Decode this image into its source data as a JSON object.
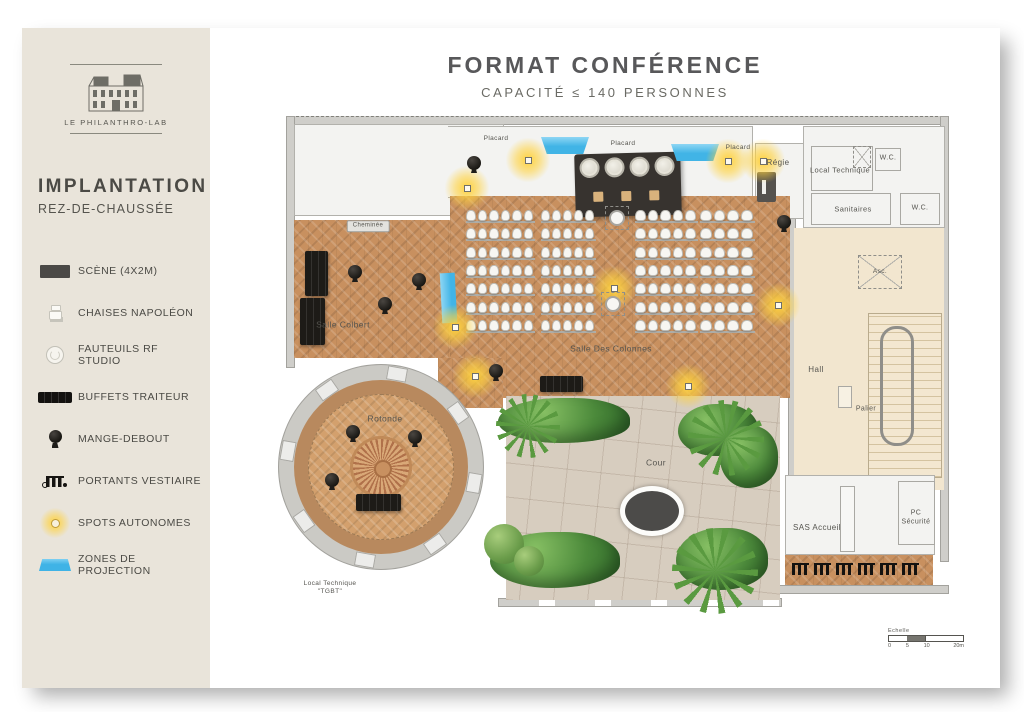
{
  "header": {
    "title": "FORMAT CONFÉRENCE",
    "subtitle": "CAPACITÉ ≤ 140 PERSONNES"
  },
  "sidebar": {
    "logo_caption": "LE PHILANTHRO-LAB",
    "heading": "IMPLANTATION",
    "subheading": "REZ-DE-CHAUSSÉE",
    "legend": [
      {
        "icon": "stage-icon",
        "label": "SCÈNE (4X2M)"
      },
      {
        "icon": "napoleon-chair-icon",
        "label": "CHAISES NAPOLÉON"
      },
      {
        "icon": "rf-armchair-icon",
        "label": "FAUTEUILS RF STUDIO"
      },
      {
        "icon": "buffet-icon",
        "label": "BUFFETS TRAITEUR"
      },
      {
        "icon": "standing-table-icon",
        "label": "MANGE-DEBOUT"
      },
      {
        "icon": "coat-rack-icon",
        "label": "PORTANTS VESTIAIRE"
      },
      {
        "icon": "spot-icon",
        "label": "SPOTS AUTONOMES"
      },
      {
        "icon": "projection-zone-icon",
        "label": "ZONES DE PROJECTION"
      }
    ]
  },
  "plan": {
    "labels": [
      {
        "t": "Placard",
        "x": 228,
        "y": 31,
        "s": 6.5
      },
      {
        "t": "Placard",
        "x": 355,
        "y": 36,
        "s": 6.5
      },
      {
        "t": "Placard",
        "x": 470,
        "y": 40,
        "s": 6.5
      },
      {
        "t": "Régie",
        "x": 510,
        "y": 55,
        "s": 8
      },
      {
        "t": "Local Technique",
        "x": 572,
        "y": 62,
        "s": 7.5
      },
      {
        "t": "W.C.",
        "x": 620,
        "y": 51,
        "s": 7
      },
      {
        "t": "Sanitaires",
        "x": 585,
        "y": 101,
        "s": 7.5
      },
      {
        "t": "W.C.",
        "x": 652,
        "y": 101,
        "s": 7
      },
      {
        "t": "Asc.",
        "x": 612,
        "y": 164,
        "s": 6.5
      },
      {
        "t": "Cheminée",
        "x": 100,
        "y": 118,
        "s": 6,
        "chip": true
      },
      {
        "t": "Salle Colbert",
        "x": 75,
        "y": 217,
        "s": 8.5
      },
      {
        "t": "Salle Des Colonnes",
        "x": 343,
        "y": 241,
        "s": 8.5
      },
      {
        "t": "Rotonde",
        "x": 117,
        "y": 311,
        "s": 8.5
      },
      {
        "t": "Cour",
        "x": 388,
        "y": 355,
        "s": 8.5
      },
      {
        "t": "Hall",
        "x": 548,
        "y": 262,
        "s": 8
      },
      {
        "t": "Palier",
        "x": 598,
        "y": 302,
        "s": 7
      },
      {
        "t": "SAS Accueil",
        "x": 549,
        "y": 420,
        "s": 8
      },
      {
        "t": "PC\nSécurité",
        "x": 648,
        "y": 410,
        "s": 7
      },
      {
        "t": "Local Technique\n\"TGBT\"",
        "x": 62,
        "y": 480,
        "s": 6.5
      }
    ],
    "spots": [
      [
        199,
        80
      ],
      [
        260,
        52
      ],
      [
        460,
        53
      ],
      [
        495,
        53
      ],
      [
        187,
        219
      ],
      [
        346,
        180
      ],
      [
        510,
        197
      ],
      [
        207,
        268
      ],
      [
        420,
        278
      ]
    ],
    "standing_tables": [
      [
        206,
        55
      ],
      [
        516,
        114
      ],
      [
        87,
        164
      ],
      [
        151,
        172
      ],
      [
        117,
        196
      ],
      [
        85,
        324
      ],
      [
        147,
        329
      ],
      [
        64,
        372
      ],
      [
        228,
        263
      ]
    ],
    "buffets": [
      [
        37,
        143,
        23,
        45
      ],
      [
        32,
        190,
        25,
        47
      ],
      [
        88,
        386,
        45,
        17
      ],
      [
        272,
        268,
        43,
        16
      ]
    ],
    "columns": [
      [
        349,
        110
      ],
      [
        345,
        196
      ]
    ],
    "projection_zones": [
      [
        273,
        29,
        48,
        17
      ],
      [
        403,
        36,
        48,
        17
      ]
    ],
    "projection_band": [
      173,
      165,
      15,
      50
    ],
    "coat_racks": {
      "x0": 524,
      "dx": 22,
      "y": 455,
      "n": 6
    },
    "seating_blocks": [
      {
        "x": 198,
        "y": 102,
        "rows": 7,
        "cols": 6,
        "cw": 11.5,
        "rh": 18.3
      },
      {
        "x": 273,
        "y": 102,
        "rows": 7,
        "cols": 5,
        "cw": 11.0,
        "rh": 18.3
      },
      {
        "x": 367,
        "y": 102,
        "rows": 7,
        "cols": 5,
        "cw": 12.6,
        "rh": 18.3
      },
      {
        "x": 432,
        "y": 102,
        "rows": 7,
        "cols": 4,
        "cw": 13.7,
        "rh": 18.3
      }
    ],
    "rotonde_piers": {
      "cx": 113,
      "cy": 359,
      "r": 94,
      "angles": [
        10,
        55,
        100,
        145,
        190,
        235,
        280,
        325
      ]
    },
    "scale": {
      "label": "Echelle",
      "ticks": [
        "0",
        "5",
        "10",
        "20m"
      ]
    }
  },
  "colors": {
    "accent_blue": "#41b4e6",
    "spot_yellow": "#ffd23e",
    "parquet": "#c8905f",
    "sidebar_bg": "#e9e4da"
  }
}
